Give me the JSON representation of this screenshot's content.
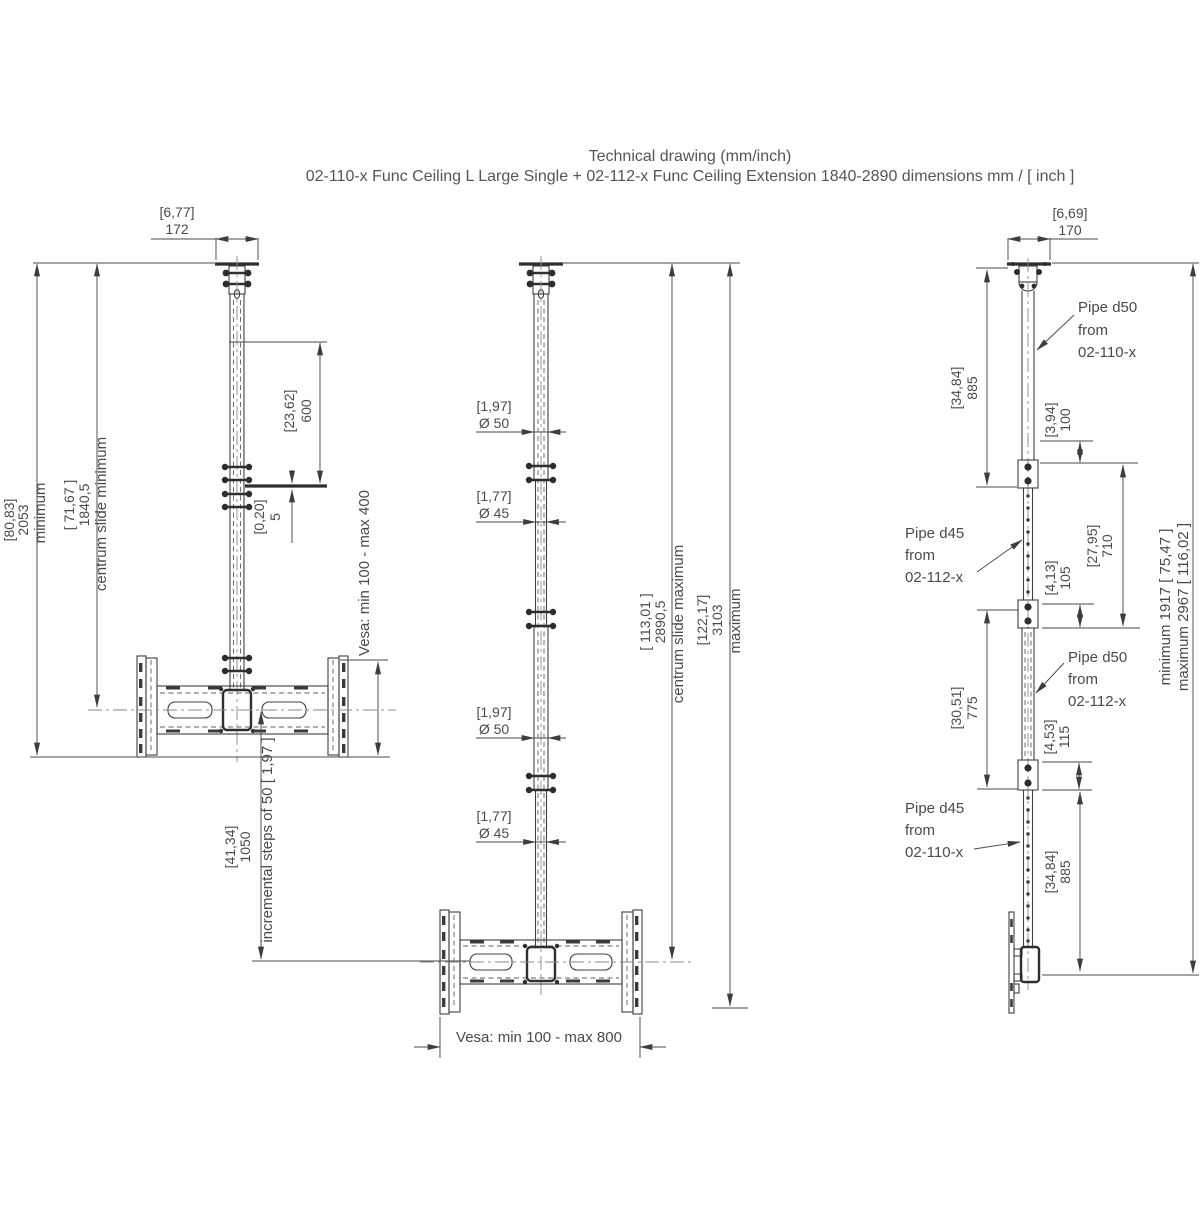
{
  "title": {
    "line1": "Technical drawing (mm/inch)",
    "line2": "02-110-x Func Ceiling L Large Single + 02-112-x Func Ceiling Extension 1840-2890 dimensions mm / [ inch ]"
  },
  "colors": {
    "line": "#3f3f3f",
    "text": "#4a4a4a",
    "background": "#ffffff"
  },
  "left": {
    "width": {
      "inch": "[6,77]",
      "mm": "172"
    },
    "total": {
      "inch": "[80,83]",
      "mm": "2053",
      "label": "minimum"
    },
    "centrum": {
      "inch": "[ 71,67 ]",
      "mm": "1840,5",
      "label": "centrum slide minimum"
    },
    "slide": {
      "inch": "[23,62]",
      "mm": "600"
    },
    "step": {
      "inch": "[0,20]",
      "mm": "5"
    },
    "vesa": "Vesa: min 100 - max 400",
    "steps": {
      "inch": "[41,34]",
      "mm": "1050",
      "label": "incremental steps of 50 [ 1,97 ]"
    }
  },
  "middle": {
    "dia1": {
      "inch": "[1,97]",
      "mm": "Ø 50"
    },
    "dia2": {
      "inch": "[1,77]",
      "mm": "Ø 45"
    },
    "dia3": {
      "inch": "[1,97]",
      "mm": "Ø 50"
    },
    "dia4": {
      "inch": "[1,77]",
      "mm": "Ø 45"
    },
    "centrum": {
      "inch": "[ 113,01 ]",
      "mm": "2890,5",
      "label": "centrum slide maximum"
    },
    "total": {
      "inch": "[122,17]",
      "mm": "3103",
      "label": "maximum"
    },
    "vesa": "Vesa: min 100 - max 800"
  },
  "right": {
    "width": {
      "inch": "[6,69]",
      "mm": "170"
    },
    "seg_top": {
      "inch": "[34,84]",
      "mm": "885"
    },
    "d100": {
      "inch": "[3,94]",
      "mm": "100"
    },
    "d710": {
      "inch": "[27,95]",
      "mm": "710"
    },
    "d105": {
      "inch": "[4,13]",
      "mm": "105"
    },
    "d775": {
      "inch": "[30,51]",
      "mm": "775"
    },
    "d115": {
      "inch": "[4,53]",
      "mm": "115"
    },
    "seg_bottom": {
      "inch": "[34,84]",
      "mm": "885"
    },
    "label_d50_top": {
      "l1": "Pipe d50",
      "l2": "from",
      "l3": "02-110-x"
    },
    "label_d45_ext": {
      "l1": "Pipe d45",
      "l2": "from",
      "l3": "02-112-x"
    },
    "label_d50_ext": {
      "l1": "Pipe d50",
      "l2": "from",
      "l3": "02-112-x"
    },
    "label_d45_bot": {
      "l1": "Pipe d45",
      "l2": "from",
      "l3": "02-110-x"
    },
    "range_min": "minimum 1917 [ 75,47 ]",
    "range_max": "maximum 2967 [ 116,02 ]"
  }
}
